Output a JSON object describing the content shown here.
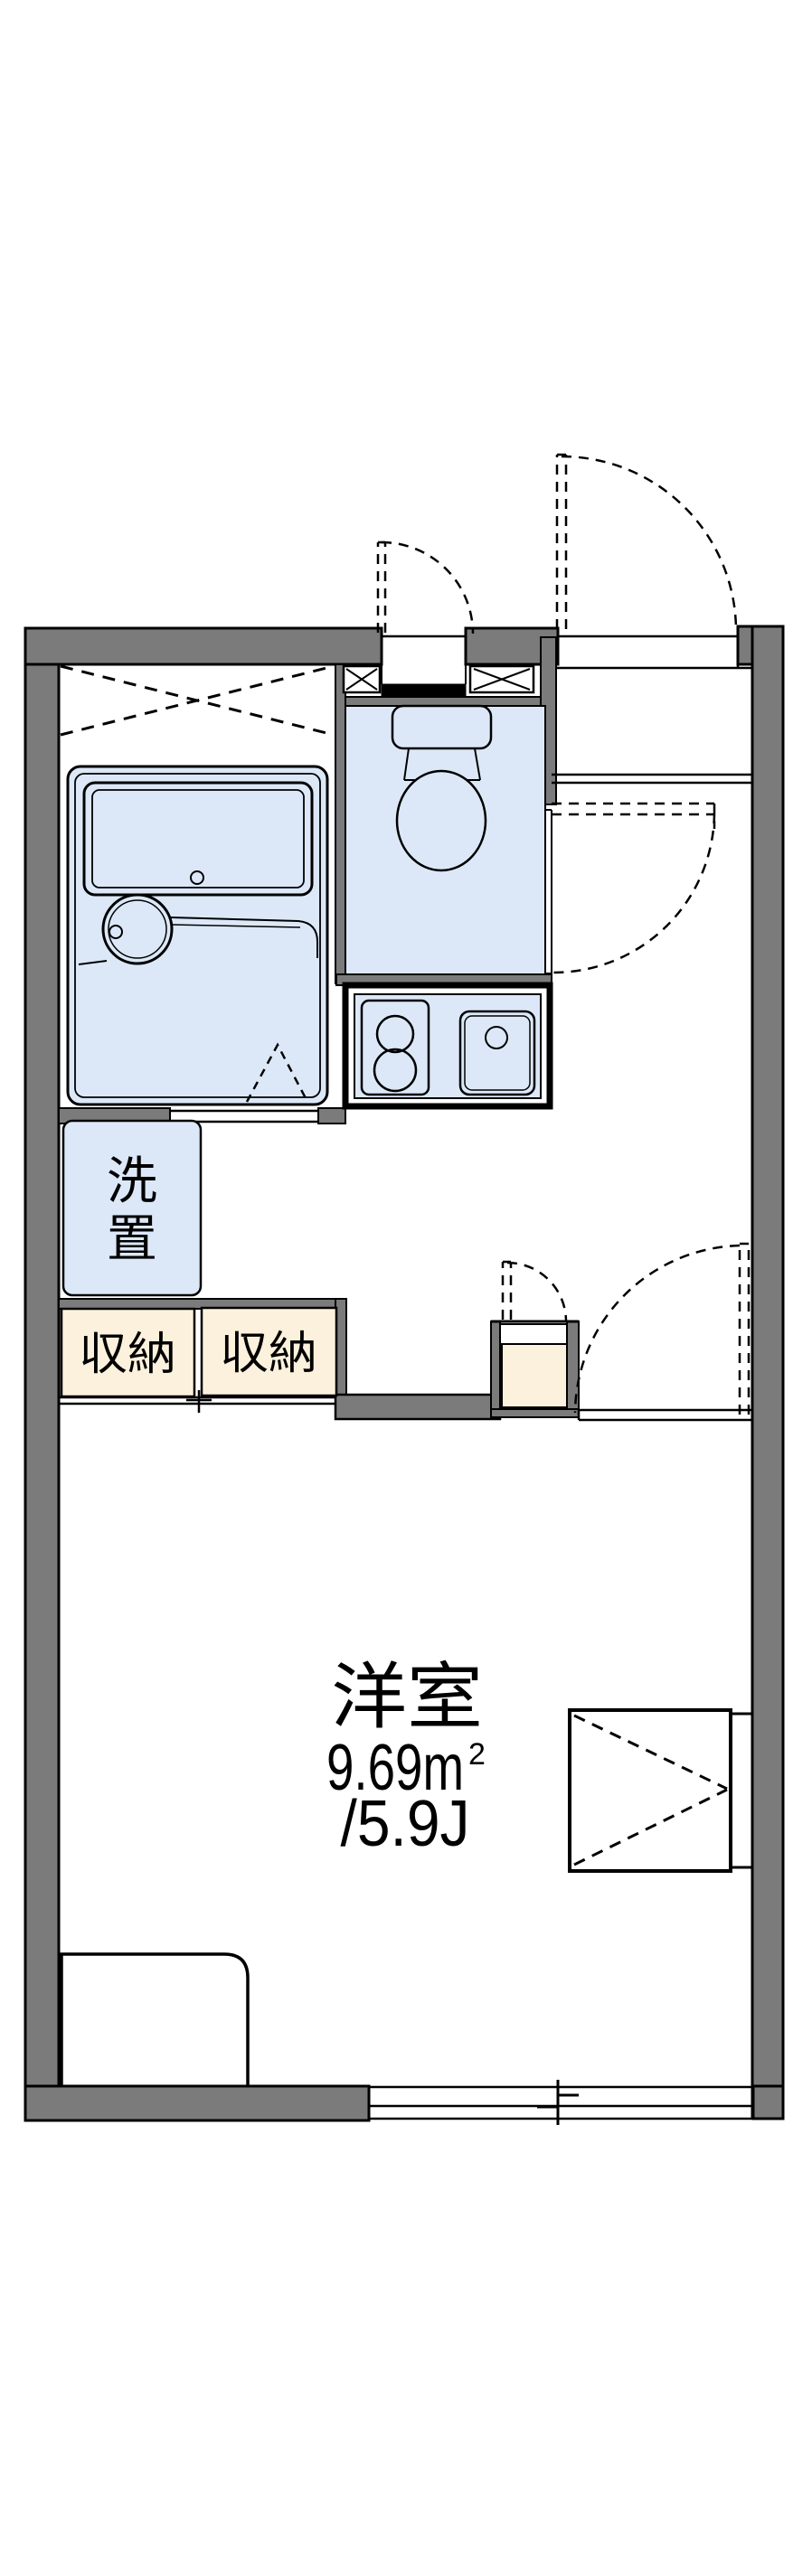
{
  "colors": {
    "wall": "#7b7b7b",
    "fixture_blue": "#dce8f8",
    "storage_beige": "#fcf1dc",
    "line": "#000000",
    "background": "#ffffff"
  },
  "labels": {
    "room_name": "洋室",
    "room_area_main": "9.69m",
    "room_area_sup": "2",
    "room_tatami": "/5.9J",
    "laundry_top": "洗",
    "laundry_bottom": "置",
    "closet_left": "収納",
    "closet_right": "収納"
  }
}
